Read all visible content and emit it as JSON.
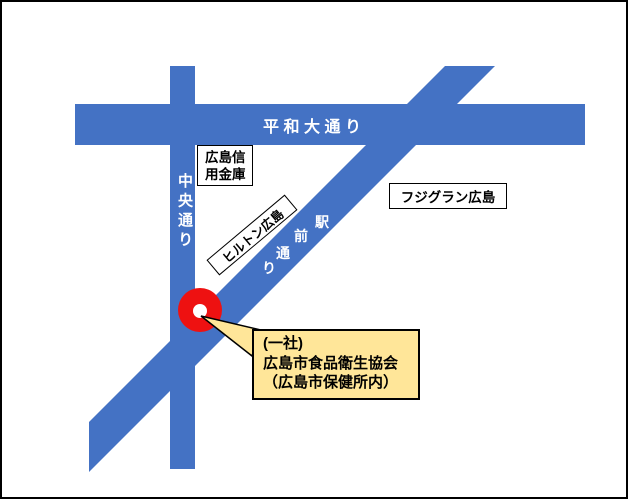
{
  "colors": {
    "road_blue": "#4472C4",
    "marker_red": "#EE1111",
    "marker_hole": "#FFFFFF",
    "callout_fill": "#FFE699",
    "outline": "#000000",
    "road_text": "#FFFFFF"
  },
  "roads": {
    "heiwa": {
      "label": "平和大通り"
    },
    "chuo": {
      "label": "中央通り"
    },
    "ekimae": {
      "chars": [
        "駅",
        "前",
        "通",
        "り"
      ]
    }
  },
  "places": {
    "shinkin": {
      "lines": [
        "広島信",
        "用金庫"
      ]
    },
    "fujigran": {
      "label": "フジグラン広島"
    },
    "hilton": {
      "label": "ヒルトン広島"
    }
  },
  "callout": {
    "lines": [
      "(一社)",
      "広島市食品衛生協会",
      "（広島市保健所内）"
    ]
  }
}
